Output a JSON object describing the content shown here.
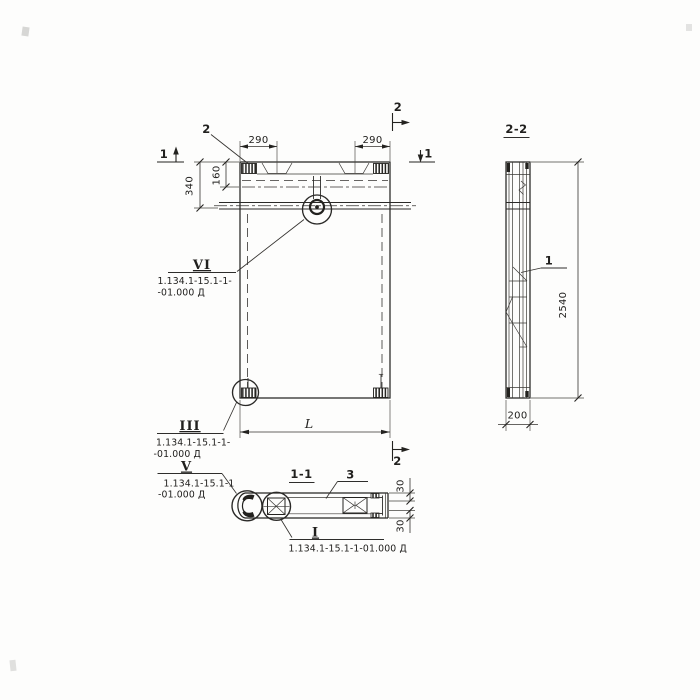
{
  "front_view": {
    "callout_2": "2",
    "sec1_left": "1",
    "sec1_right": "1",
    "sec2_top": "2",
    "sec2_bottom": "2",
    "dim_290_left": "290",
    "dim_290_right": "290",
    "dim_340": "340",
    "dim_160": "160",
    "dim_L": "L",
    "detail_vi": {
      "label": "VI",
      "line1": "1.134.1-15.1-1-",
      "line2": "-01.000 Д"
    },
    "detail_iii": {
      "label": "III",
      "line1": "1.134.1-15.1-1-",
      "line2": "-01.000 Д"
    }
  },
  "side_view": {
    "title": "2-2",
    "callout_1": "1",
    "dim_2540": "2540",
    "dim_200": "200"
  },
  "section_view": {
    "title": "1-1",
    "callout_3": "3",
    "dim_30_top": "30",
    "dim_30_bottom": "30",
    "detail_v": {
      "label": "V",
      "line1": "1.134.1-15.1-1",
      "line2": "-01.000 Д"
    },
    "detail_i": {
      "label": "I",
      "line1": "1.134.1-15.1-1-01.000 Д"
    }
  }
}
